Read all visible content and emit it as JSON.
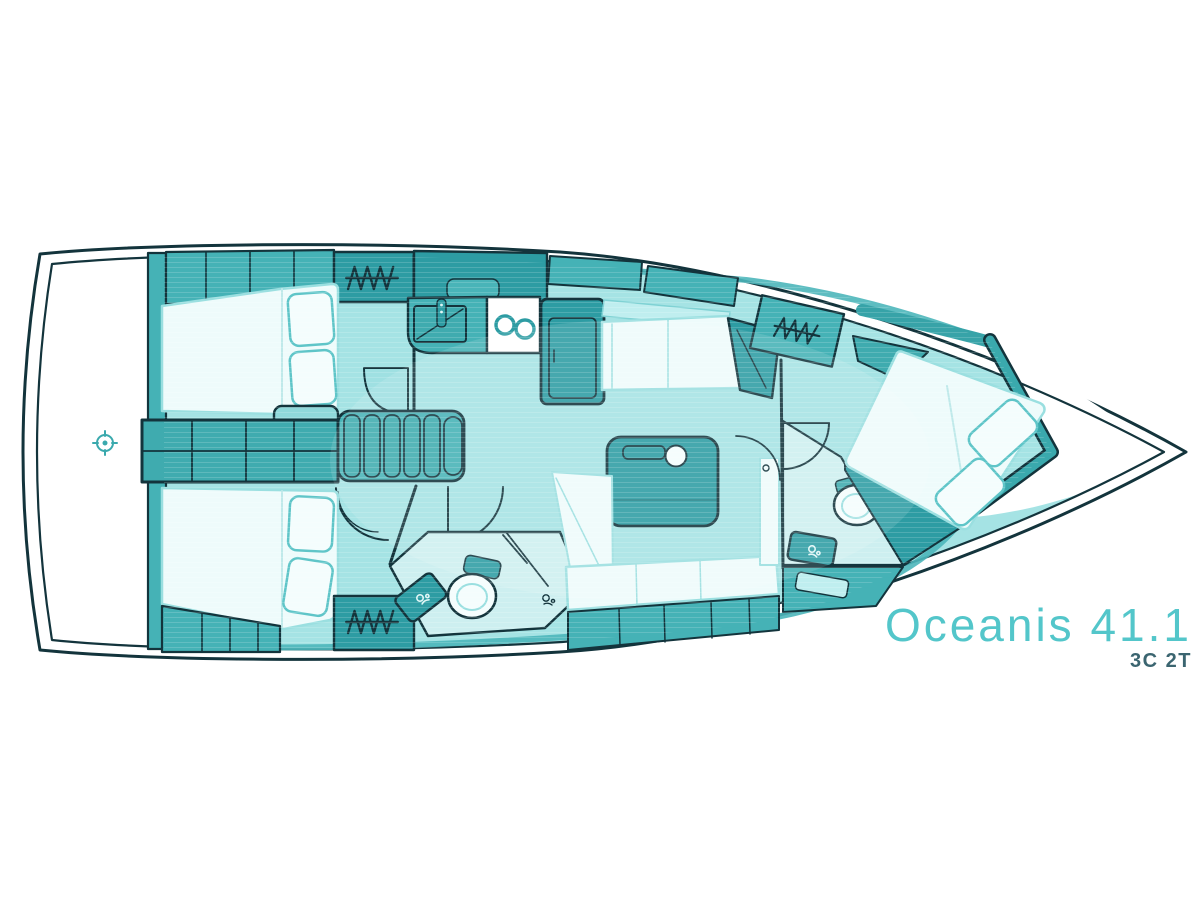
{
  "header": {
    "title": "Oceanis 41.1",
    "variant": "3C 2T"
  },
  "colors": {
    "background": "#ffffff",
    "hull_line": "#13343c",
    "floor": "#a5e3e4",
    "floor_light": "#cdeff0",
    "furniture": "#45b2b6",
    "furniture_dark": "#2d9ca3",
    "fixture_white": "#eefbfb",
    "accent_band": "#3aa9ad",
    "title_text": "#53c6ca",
    "variant_text": "#3b6570"
  },
  "icons": {
    "helm": "circled crosshair at stern",
    "hanging_locker": "zigzag hanger glyph (3 lockers)",
    "stove_burners": "two rings",
    "faucet": "small spout squiggle"
  }
}
